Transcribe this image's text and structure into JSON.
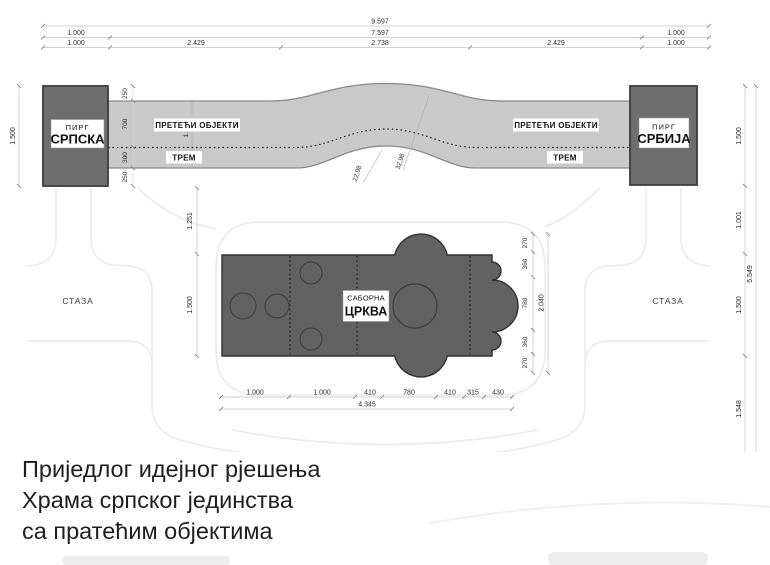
{
  "drawing": {
    "top_dims": {
      "total": "9.597",
      "row2": [
        "1.000",
        "7.597",
        "1.000"
      ],
      "row3": [
        "1.000",
        "2.429",
        "2.738",
        "2.429",
        "1.000"
      ]
    },
    "left_dims": {
      "outer": "1.500",
      "band": [
        "250",
        "700",
        "300",
        "250"
      ],
      "church": [
        "1.251",
        "1.500"
      ]
    },
    "right_dims": {
      "outer": [
        "1.500",
        "1.001",
        "1.500",
        "1.548"
      ],
      "outer_total": "5.549",
      "church": [
        "270",
        "360",
        "780",
        "360",
        "270"
      ],
      "church_total": "2.040"
    },
    "bottom_dims": {
      "row1": [
        "1.000",
        "1.000",
        "410",
        "780",
        "410",
        "315",
        "430"
      ],
      "total": "4.345"
    },
    "band": {
      "upper_label_left": "ПРЕТЕЋИ ОБЈЕКТИ",
      "upper_label_right": "ПРЕТЕЋИ ОБЈЕКТИ",
      "lower_label_left": "ТРЕМ",
      "lower_label_right": "ТРЕМ",
      "width_note": "1.00",
      "arc_radius_left": "22,98",
      "arc_radius_right": "32,98"
    },
    "towers": {
      "left": {
        "caption": "ПИРГ",
        "name": "СРПСКА"
      },
      "right": {
        "caption": "ПИРГ",
        "name": "СРБИЈА"
      }
    },
    "church": {
      "caption": "САБОРНА",
      "name": "ЦРКВА"
    },
    "paths": {
      "left": "СТАЗА",
      "right": "СТАЗА"
    }
  },
  "title_block": {
    "line1": "Приједлог идејног рјешења",
    "line2": "Храма српског јединства",
    "line3": "са пратећим објектима"
  },
  "colors": {
    "tower_fill": "#6e6e6e",
    "band_fill": "#c9c9c9",
    "church_fill": "#626262",
    "faint_path": "#ebebeb",
    "dim_line": "#c3c3c3",
    "text": "#1f1f1f"
  }
}
